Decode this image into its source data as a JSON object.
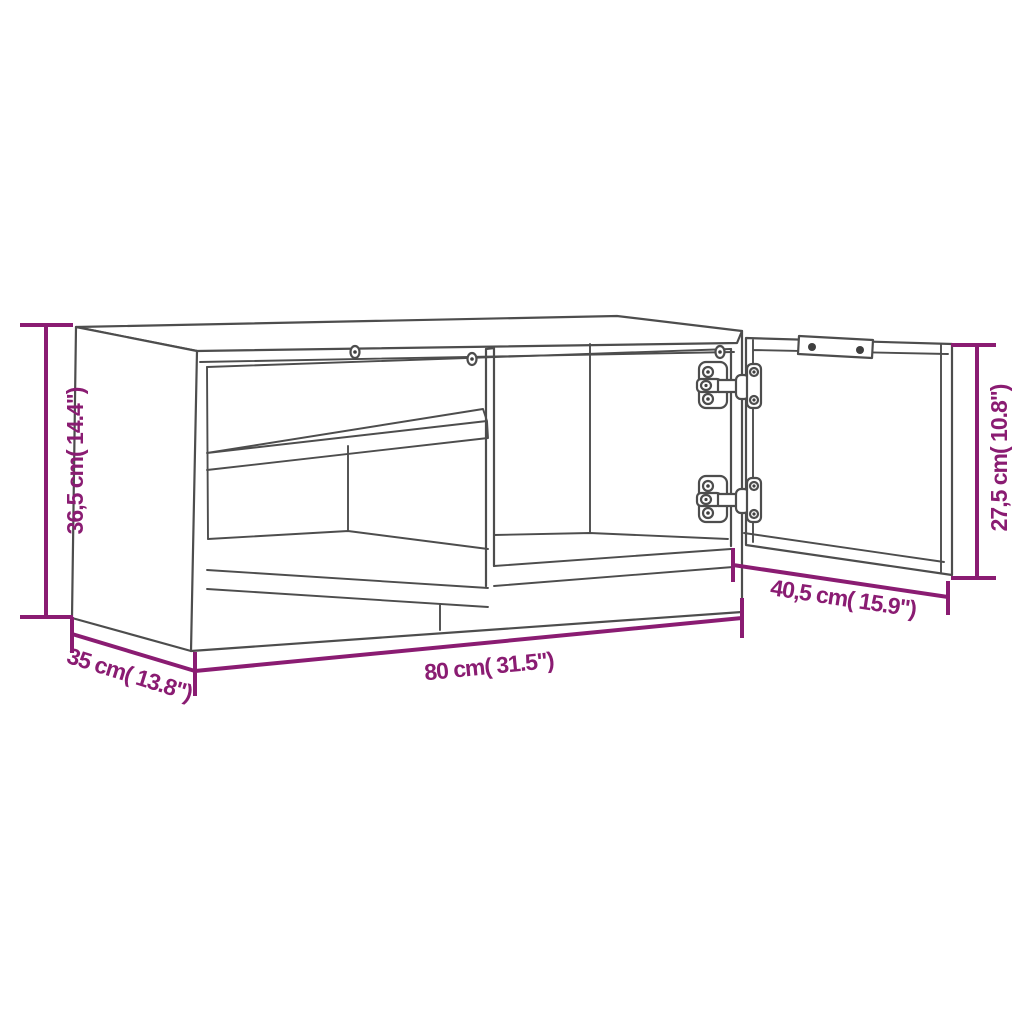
{
  "diagram": {
    "kind": "furniture-dimension-diagram",
    "subject": "tv-cabinet-with-open-door",
    "background": "#ffffff",
    "colors": {
      "dimension_accent": "#8a1c72",
      "line_art": "#4d4d4d",
      "hardware_dark": "#3f3f3f"
    },
    "dimensions": {
      "height": {
        "cm": "36,5",
        "inch": "14.4",
        "label": "36,5 cm( 14.4\")"
      },
      "door_height": {
        "cm": "27,5",
        "inch": "10.8",
        "label": "27,5 cm( 10.8\")"
      },
      "width": {
        "cm": "80",
        "inch": "31.5",
        "label": "80 cm( 31.5\")"
      },
      "depth": {
        "cm": "35",
        "inch": "13.8",
        "label": "35 cm( 13.8\")"
      },
      "door_width": {
        "cm": "40,5",
        "inch": "15.9",
        "label": "40,5 cm( 15.9\")"
      }
    }
  }
}
